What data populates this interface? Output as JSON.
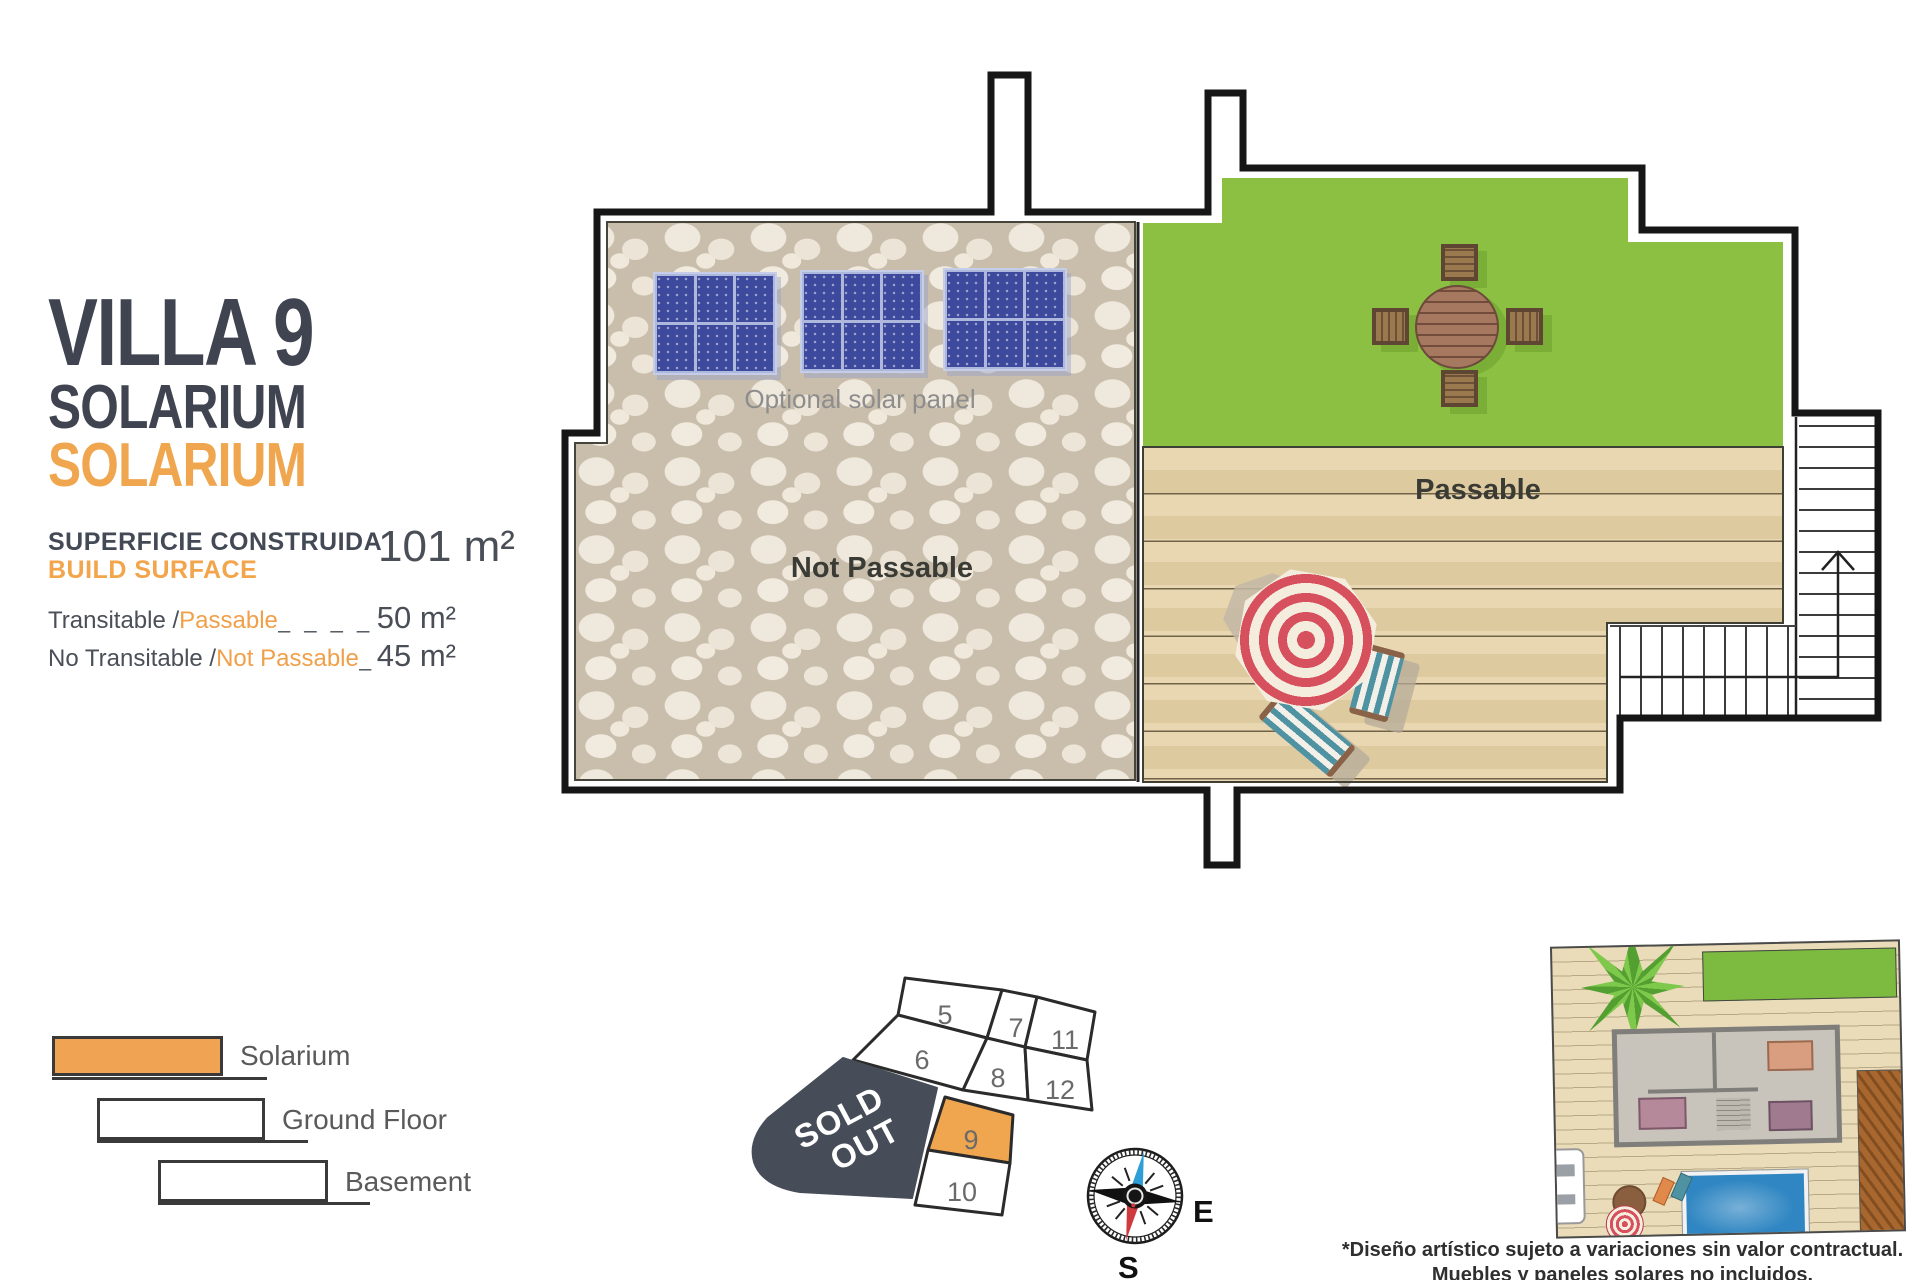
{
  "header": {
    "title": "VILLA 9",
    "floor_name": "SOLARIUM",
    "floor_name_accent": "SOLARIUM",
    "surface_label_line1": "SUPERFICIE CONSTRUIDA",
    "surface_label_line2": "BUILD SURFACE",
    "surface_value": "101 m²"
  },
  "areas": {
    "rows": [
      {
        "prefix": "Transitable / ",
        "accent": "Passable",
        "dashes": "_ _ _ _ _ _ _ _",
        "value": "50 m²"
      },
      {
        "prefix": "No Transitable / ",
        "accent": "Not Passable",
        "dashes": "_ _ _ _",
        "value": "45 m²"
      }
    ]
  },
  "legend": {
    "items": [
      {
        "label": "Solarium"
      },
      {
        "label": "Ground Floor"
      },
      {
        "label": "Basement"
      }
    ]
  },
  "plan": {
    "solar_panel_label": "Optional solar panel",
    "not_passable_label": "Not Passable",
    "passable_label": "Passable"
  },
  "plot_map": {
    "sold_out_line1": "SOLD",
    "sold_out_line2": "OUT",
    "highlighted_cell": "9",
    "cells": [
      {
        "n": "5"
      },
      {
        "n": "6"
      },
      {
        "n": "7"
      },
      {
        "n": "8"
      },
      {
        "n": "11"
      },
      {
        "n": "12"
      },
      {
        "n": "9"
      },
      {
        "n": "10"
      }
    ]
  },
  "compass": {
    "east_label": "E",
    "south_label": "S"
  },
  "footnote": {
    "line1": "*Diseño artístico sujeto a variaciones sin valor contractual.",
    "line2": "Muebles y paneles solares no incluidos."
  },
  "colors": {
    "accent_orange": "#F0A64F",
    "title_dark": "#3F4450",
    "grass_green": "#8CC043",
    "deck_tan": "#E6D3A8",
    "panel_blue": "#3C499C",
    "sold_out_dark": "#474D58",
    "umbrella_red": "#D7505E",
    "compass_north_blue": "#2D9FD6",
    "compass_south_red": "#CF3A3F"
  }
}
